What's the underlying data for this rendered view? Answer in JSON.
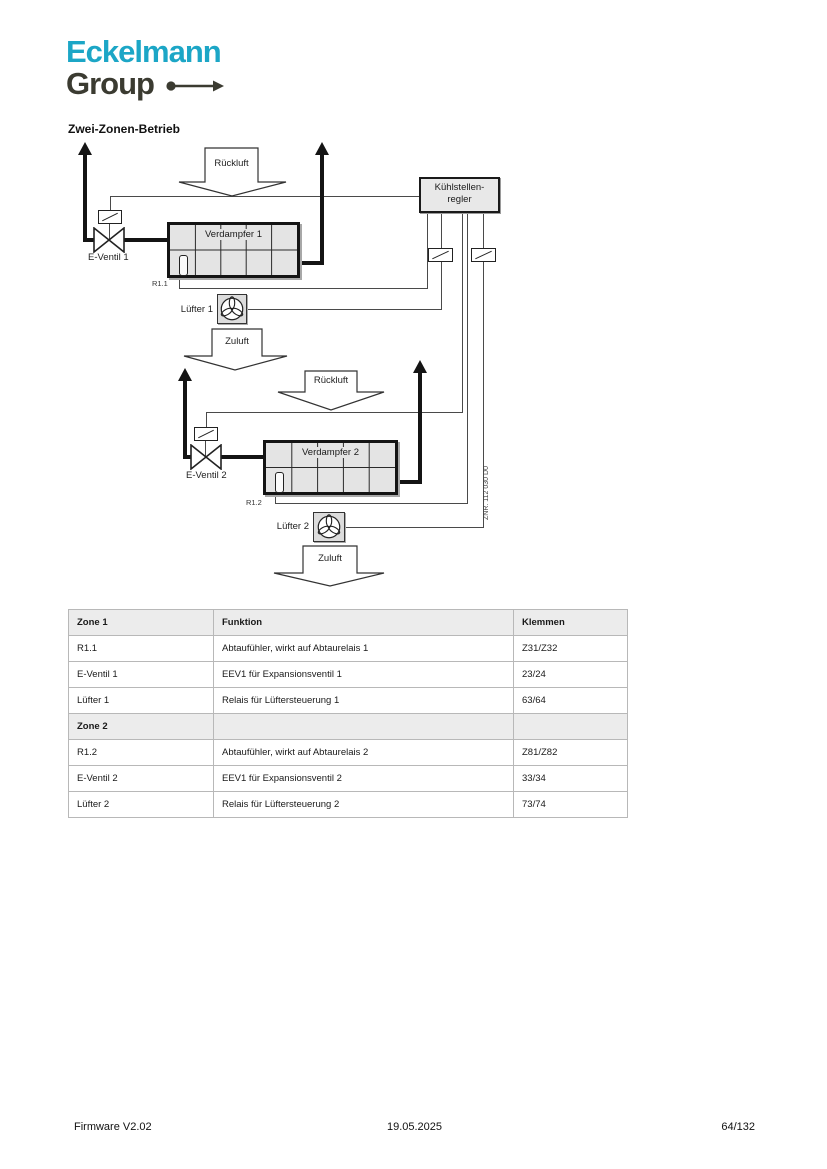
{
  "logo": {
    "line1": "Eckelmann",
    "line2": "Group"
  },
  "heading": "Zwei-Zonen-Betrieb",
  "colors": {
    "brand_cyan": "#1CA6C6",
    "brand_dark": "#3B3B31",
    "diagram_fill": "#E4E4E4",
    "table_header_bg": "#ECECEC"
  },
  "diagram": {
    "controller": {
      "line1": "Kühlstellen-",
      "line2": "regler"
    },
    "arrows": {
      "rueckluft1": "Rückluft",
      "zuluft1": "Zuluft",
      "rueckluft2": "Rückluft",
      "zuluft2": "Zuluft"
    },
    "labels": {
      "evaporator1": "Verdampfer 1",
      "evaporator2": "Verdampfer 2",
      "valve1": "E-Ventil 1",
      "valve2": "E-Ventil 2",
      "sensor1": "R1.1",
      "sensor2": "R1.2",
      "fan1": "Lüfter 1",
      "fan2": "Lüfter 2",
      "drawing_number": "ZNR. 112 030 D0"
    }
  },
  "table": {
    "headers": [
      "Zone 1",
      "Funktion",
      "Klemmen"
    ],
    "rows": [
      {
        "type": "data",
        "cells": [
          "R1.1",
          "Abtaufühler, wirkt auf Abtaurelais 1",
          "Z31/Z32"
        ]
      },
      {
        "type": "data",
        "cells": [
          "E-Ventil 1",
          "EEV1 für Expansionsventil 1",
          "23/24"
        ]
      },
      {
        "type": "data",
        "cells": [
          "Lüfter 1",
          "Relais für Lüftersteuerung 1",
          "63/64"
        ]
      },
      {
        "type": "section",
        "cells": [
          "Zone 2",
          "",
          ""
        ]
      },
      {
        "type": "data",
        "cells": [
          "R1.2",
          "Abtaufühler, wirkt auf Abtaurelais 2",
          "Z81/Z82"
        ]
      },
      {
        "type": "data",
        "cells": [
          "E-Ventil 2",
          "EEV1 für Expansionsventil 2",
          "33/34"
        ]
      },
      {
        "type": "data",
        "cells": [
          "Lüfter 2",
          "Relais für Lüftersteuerung 2",
          "73/74"
        ]
      }
    ]
  },
  "footer": {
    "left": "Firmware V2.02",
    "center": "19.05.2025",
    "right": "64/132"
  }
}
